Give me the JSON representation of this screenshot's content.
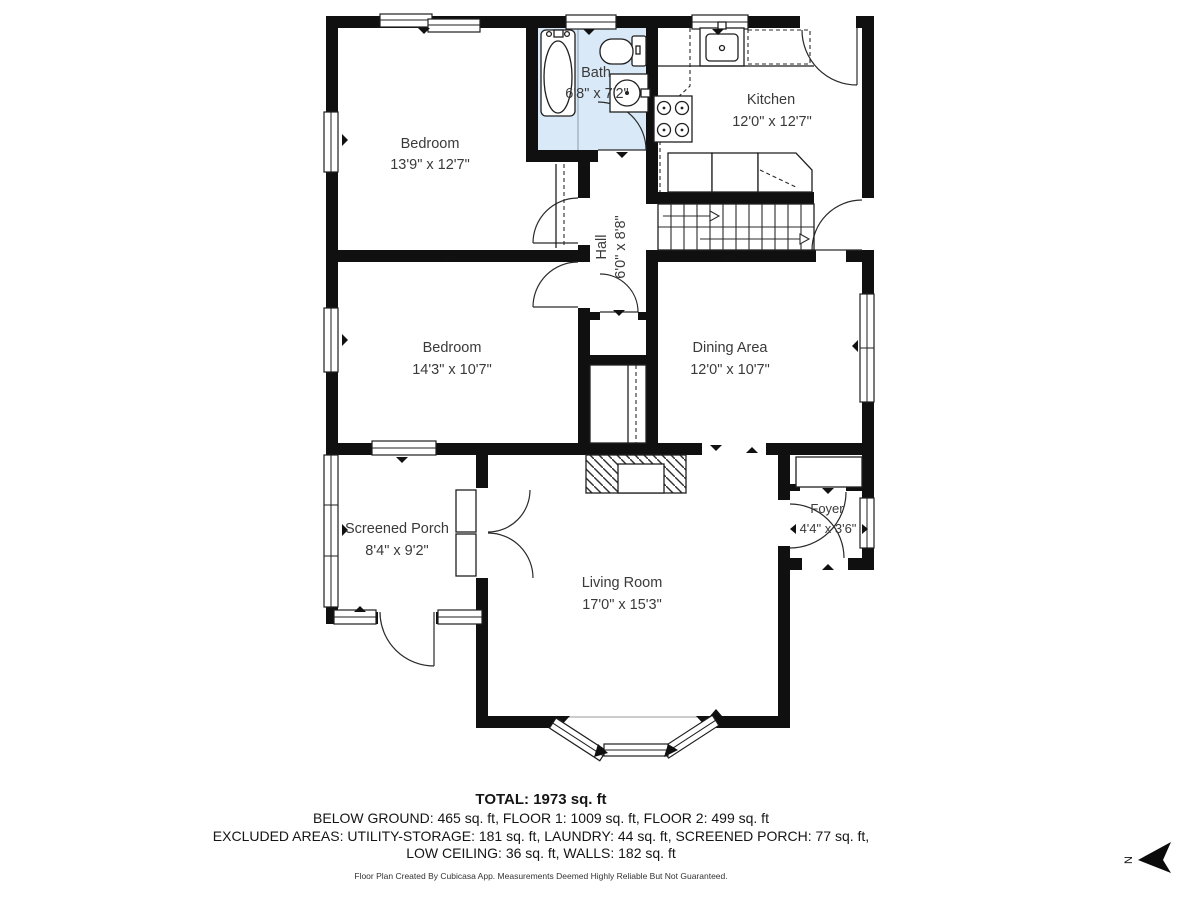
{
  "colors": {
    "wall": "#101010",
    "bath_fill": "#d9e9f7"
  },
  "rooms": [
    {
      "name": "Bedroom",
      "dims": "13'9\" x 12'7\""
    },
    {
      "name": "Bath",
      "dims": "6'8\" x 7'2\""
    },
    {
      "name": "Kitchen",
      "dims": "12'0\" x 12'7\""
    },
    {
      "name": "Hall",
      "dims": "6'0\" x 8'8\""
    },
    {
      "name": "Bedroom",
      "dims": "14'3\" x 10'7\""
    },
    {
      "name": "Dining Area",
      "dims": "12'0\" x 10'7\""
    },
    {
      "name": "Screened Porch",
      "dims": "8'4\" x 9'2\""
    },
    {
      "name": "Living Room",
      "dims": "17'0\" x 15'3\""
    },
    {
      "name": "Foyer",
      "dims": "4'4\" x 3'6\""
    }
  ],
  "summary": {
    "total": "TOTAL: 1973 sq. ft",
    "line1": "BELOW GROUND: 465 sq. ft, FLOOR 1: 1009 sq. ft, FLOOR 2: 499 sq. ft",
    "line2": "EXCLUDED AREAS: UTILITY-STORAGE: 181 sq. ft, LAUNDRY: 44 sq. ft, SCREENED PORCH: 77 sq. ft,",
    "line3": "LOW CEILING: 36 sq. ft, WALLS: 182 sq. ft",
    "disclaimer": "Floor Plan Created By Cubicasa App. Measurements Deemed Highly Reliable But Not Guaranteed."
  },
  "compass": {
    "label": "N"
  }
}
